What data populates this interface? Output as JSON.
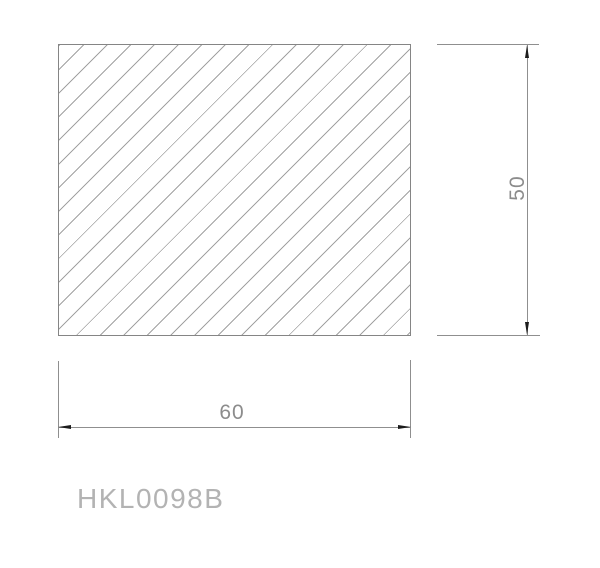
{
  "drawing": {
    "part_label": "HKL0098B",
    "width_dimension": "60",
    "height_dimension": "50",
    "hatch": {
      "angle_deg": 45,
      "spacing_px": 16.7,
      "line_px": 1
    },
    "colors": {
      "background": "#ffffff",
      "outline": "#858585",
      "hatch_line": "#a2a2a2",
      "dim_line": "#8f8f8f",
      "arrowhead": "#1c1c1c",
      "dim_text": "#8c8c8c",
      "label_text": "#b3b3b3"
    }
  }
}
